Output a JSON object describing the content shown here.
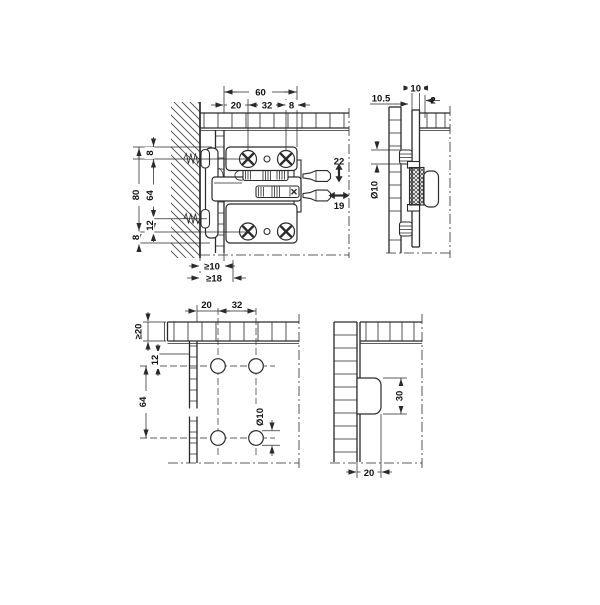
{
  "drawing": {
    "line_color": "#2a2a2a",
    "background": "#ffffff",
    "tl": {
      "w_total": "60",
      "w1": "20",
      "w2": "32",
      "w3": "8",
      "h_total": "80",
      "h_top": "8",
      "h_mid": "64",
      "h_off": "12",
      "h_bot": "8",
      "clear1": "≥10",
      "clear2": "≥18",
      "vadj_value": "22",
      "hadj_value": "19"
    },
    "tr": {
      "edge_dist": "10.5",
      "panel_th": "10",
      "gap": "2",
      "hole_dia": "Ø10"
    },
    "bl": {
      "w1": "20",
      "w2": "32",
      "edge": "≥20",
      "h1": "12",
      "h2": "64",
      "hole_dia": "Ø10"
    },
    "br": {
      "hook_h": "30",
      "depth": "20"
    }
  }
}
